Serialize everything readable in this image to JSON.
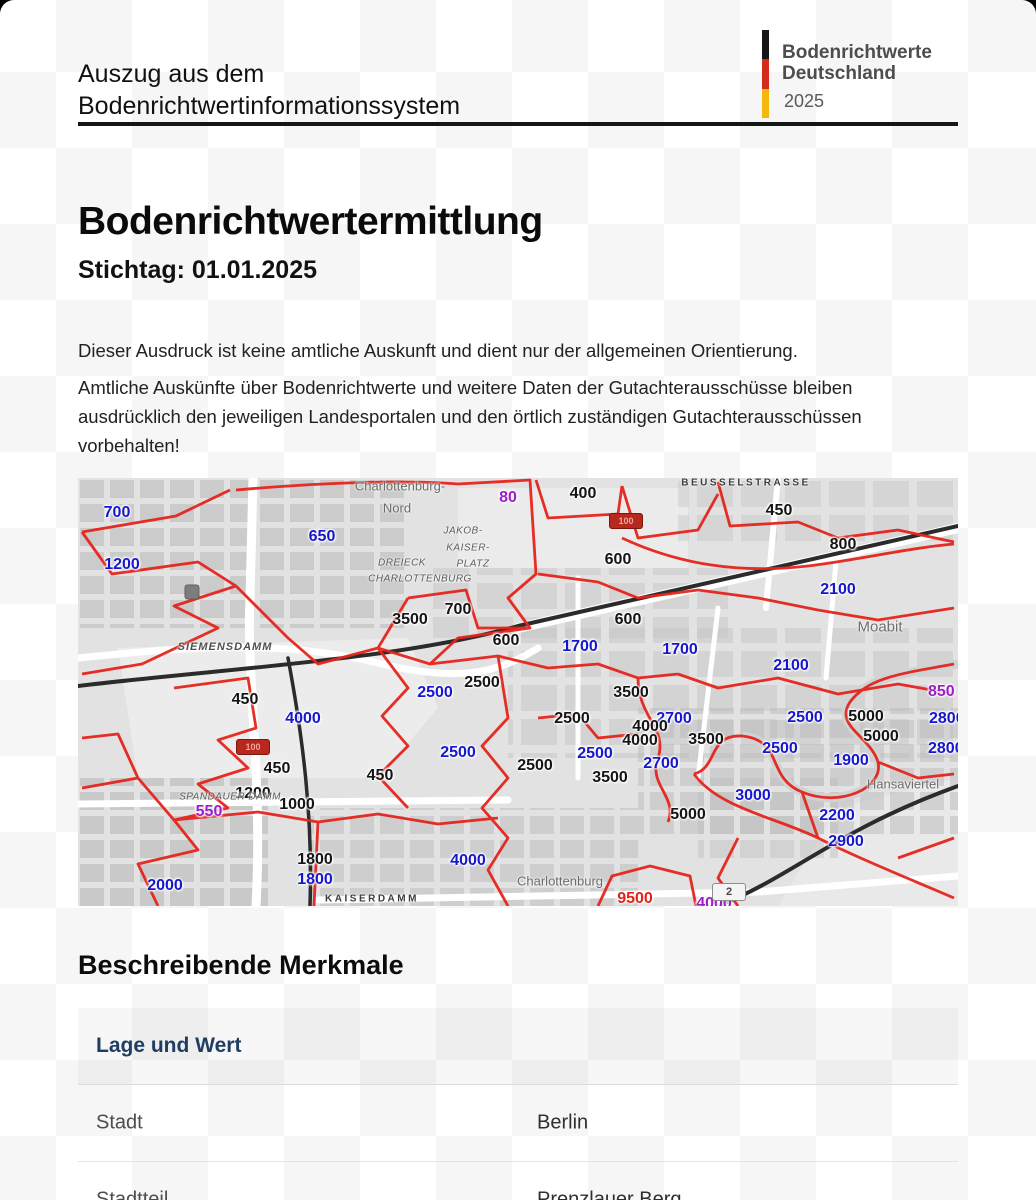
{
  "header": {
    "title_line1": "Auszug aus dem",
    "title_line2": "Bodenrichtwertinformationssystem",
    "logo": {
      "line1": "Bodenrichtwerte",
      "line2": "Deutschland",
      "year": "2025",
      "flag_colors": [
        "#161616",
        "#d42b1f",
        "#f2b80c"
      ]
    }
  },
  "main": {
    "heading": "Bodenrichtwertermittlung",
    "subheading": "Stichtag: 01.01.2025",
    "paragraph1": "Dieser Ausdruck ist keine amtliche Auskunft und dient nur der allgemeinen Orientierung.",
    "paragraph2": "Amtliche Auskünfte über Bodenrichtwerte und weitere Daten der Gutachterausschüsse bleiben ausdrücklich den jeweiligen Landesportalen und den örtlich zuständigen Gutachterausschüssen vorbehalten!"
  },
  "map": {
    "value_colors": {
      "blue": "#1616cc",
      "black": "#141414",
      "purple": "#9c1ec8",
      "red": "#e02318"
    },
    "values": [
      {
        "x": 39,
        "y": 35,
        "t": "700",
        "c": "blue"
      },
      {
        "x": 44,
        "y": 87,
        "t": "1200",
        "c": "blue"
      },
      {
        "x": 244,
        "y": 59,
        "t": "650",
        "c": "blue"
      },
      {
        "x": 760,
        "y": 112,
        "t": "2100",
        "c": "blue"
      },
      {
        "x": 502,
        "y": 169,
        "t": "1700",
        "c": "blue"
      },
      {
        "x": 602,
        "y": 172,
        "t": "1700",
        "c": "blue"
      },
      {
        "x": 713,
        "y": 188,
        "t": "2100",
        "c": "blue"
      },
      {
        "x": 357,
        "y": 215,
        "t": "2500",
        "c": "blue"
      },
      {
        "x": 380,
        "y": 275,
        "t": "2500",
        "c": "blue"
      },
      {
        "x": 517,
        "y": 276,
        "t": "2500",
        "c": "blue"
      },
      {
        "x": 596,
        "y": 241,
        "t": "2700",
        "c": "blue"
      },
      {
        "x": 727,
        "y": 240,
        "t": "2500",
        "c": "blue"
      },
      {
        "x": 702,
        "y": 271,
        "t": "2500",
        "c": "blue"
      },
      {
        "x": 583,
        "y": 286,
        "t": "2700",
        "c": "blue"
      },
      {
        "x": 773,
        "y": 283,
        "t": "1900",
        "c": "blue"
      },
      {
        "x": 675,
        "y": 318,
        "t": "3000",
        "c": "blue"
      },
      {
        "x": 759,
        "y": 338,
        "t": "2200",
        "c": "blue"
      },
      {
        "x": 768,
        "y": 364,
        "t": "2900",
        "c": "blue"
      },
      {
        "x": 225,
        "y": 241,
        "t": "4000",
        "c": "blue"
      },
      {
        "x": 87,
        "y": 408,
        "t": "2000",
        "c": "blue"
      },
      {
        "x": 237,
        "y": 402,
        "t": "1800",
        "c": "blue"
      },
      {
        "x": 390,
        "y": 383,
        "t": "4000",
        "c": "blue"
      },
      {
        "x": 505,
        "y": 16,
        "t": "400",
        "c": "black"
      },
      {
        "x": 701,
        "y": 33,
        "t": "450",
        "c": "black"
      },
      {
        "x": 765,
        "y": 67,
        "t": "800",
        "c": "black"
      },
      {
        "x": 540,
        "y": 82,
        "t": "600",
        "c": "black"
      },
      {
        "x": 332,
        "y": 142,
        "t": "3500",
        "c": "black"
      },
      {
        "x": 380,
        "y": 132,
        "t": "700",
        "c": "black"
      },
      {
        "x": 550,
        "y": 142,
        "t": "600",
        "c": "black"
      },
      {
        "x": 428,
        "y": 163,
        "t": "600",
        "c": "black"
      },
      {
        "x": 167,
        "y": 222,
        "t": "450",
        "c": "black"
      },
      {
        "x": 199,
        "y": 291,
        "t": "450",
        "c": "black"
      },
      {
        "x": 175,
        "y": 316,
        "t": "1200",
        "c": "black"
      },
      {
        "x": 219,
        "y": 327,
        "t": "1000",
        "c": "black"
      },
      {
        "x": 302,
        "y": 298,
        "t": "450",
        "c": "black"
      },
      {
        "x": 404,
        "y": 205,
        "t": "2500",
        "c": "black"
      },
      {
        "x": 457,
        "y": 288,
        "t": "2500",
        "c": "black"
      },
      {
        "x": 553,
        "y": 215,
        "t": "3500",
        "c": "black"
      },
      {
        "x": 494,
        "y": 241,
        "t": "2500",
        "c": "black"
      },
      {
        "x": 572,
        "y": 249,
        "t": "4000",
        "c": "black"
      },
      {
        "x": 788,
        "y": 239,
        "t": "5000",
        "c": "black"
      },
      {
        "x": 562,
        "y": 263,
        "t": "4000",
        "c": "black"
      },
      {
        "x": 628,
        "y": 262,
        "t": "3500",
        "c": "black"
      },
      {
        "x": 803,
        "y": 259,
        "t": "5000",
        "c": "black"
      },
      {
        "x": 532,
        "y": 300,
        "t": "3500",
        "c": "black"
      },
      {
        "x": 610,
        "y": 337,
        "t": "5000",
        "c": "black"
      },
      {
        "x": 237,
        "y": 382,
        "t": "1800",
        "c": "black"
      },
      {
        "x": 430,
        "y": 20,
        "t": "80",
        "c": "purple"
      },
      {
        "x": 131,
        "y": 334,
        "t": "550",
        "c": "purple"
      },
      {
        "x": 850,
        "y": 214,
        "t": "850",
        "c": "purple",
        "anchor": "left"
      },
      {
        "x": 851,
        "y": 241,
        "t": "2800",
        "c": "blue",
        "anchor": "left"
      },
      {
        "x": 850,
        "y": 271,
        "t": "2800",
        "c": "blue",
        "anchor": "left"
      },
      {
        "x": 636,
        "y": 426,
        "t": "4000",
        "c": "purple"
      },
      {
        "x": 557,
        "y": 421,
        "t": "9500",
        "c": "red"
      }
    ],
    "places": [
      {
        "x": 322,
        "y": 8,
        "t": "Charlottenburg-",
        "k": "city"
      },
      {
        "x": 319,
        "y": 30,
        "t": "Nord",
        "k": "city"
      },
      {
        "x": 385,
        "y": 53,
        "t": "JAKOB-",
        "k": "street-it-sm"
      },
      {
        "x": 390,
        "y": 70,
        "t": "KAISER-",
        "k": "street-it-sm"
      },
      {
        "x": 395,
        "y": 86,
        "t": "PLATZ",
        "k": "street-it-sm"
      },
      {
        "x": 324,
        "y": 85,
        "t": "DREIECK",
        "k": "street-it-sm"
      },
      {
        "x": 342,
        "y": 101,
        "t": "CHARLOTTENBURG",
        "k": "street-it-sm"
      },
      {
        "x": 147,
        "y": 169,
        "t": "SIEMENSDAMM",
        "k": "street-it"
      },
      {
        "x": 668,
        "y": 5,
        "t": "BEUSSELSTRASSE",
        "k": "street"
      },
      {
        "x": 802,
        "y": 149,
        "t": "Moabit",
        "k": "city-lg"
      },
      {
        "x": 152,
        "y": 319,
        "t": "SPANDAUER DAMM",
        "k": "street-it-sm"
      },
      {
        "x": 294,
        "y": 421,
        "t": "KAISERDAMM",
        "k": "street"
      },
      {
        "x": 825,
        "y": 306,
        "t": "Hansaviertel",
        "k": "city"
      },
      {
        "x": 482,
        "y": 403,
        "t": "Charlottenburg",
        "k": "city"
      }
    ],
    "badges": [
      {
        "x": 548,
        "y": 43,
        "t": "100",
        "s": "red"
      },
      {
        "x": 175,
        "y": 269,
        "t": "100",
        "s": "red"
      },
      {
        "x": 651,
        "y": 414,
        "t": "2",
        "s": "white"
      }
    ]
  },
  "section": {
    "heading": "Beschreibende Merkmale",
    "group_label": "Lage und Wert",
    "rows": [
      {
        "label": "Stadt",
        "value": "Berlin"
      },
      {
        "label": "Stadtteil",
        "value": "Prenzlauer Berg"
      }
    ]
  }
}
